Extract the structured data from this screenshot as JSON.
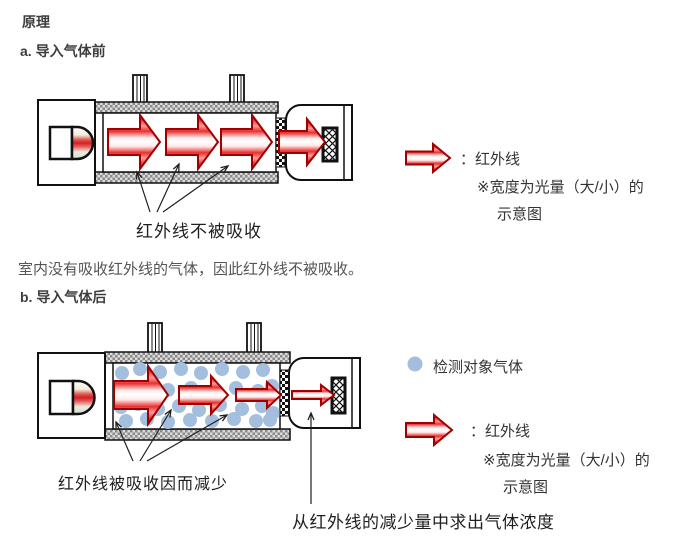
{
  "page": {
    "title": "原理",
    "background_color": "#ffffff"
  },
  "colors": {
    "infrared_red": "#d42020",
    "infrared_dark_red": "#a00000",
    "gas_blue": "#a3bfdd",
    "wall_gray": "#8a8a8a",
    "heading_text": "#3e3e3e",
    "body_text": "#555555",
    "label_text": "#1f1f1f"
  },
  "icons": {
    "infrared": "red-arrow-right-icon",
    "gas": "blue-circle-icon"
  },
  "section_a": {
    "heading": "a. 导入气体前",
    "diagram_label": "红外线不被吸收",
    "description": "室内没有吸收红外线的气体，因此红外线不被吸收。",
    "legend": {
      "infrared_label": "：红外线",
      "note_line1": "※宽度为光量（大/小）的",
      "note_line2": "示意图"
    }
  },
  "section_b": {
    "heading": "b. 导入气体后",
    "diagram_label": "红外线被吸收因而减少",
    "annotation": "从红外线的减少量中求出气体浓度",
    "legend": {
      "gas_label": "检测对象气体",
      "infrared_label": "：红外线",
      "note_line1": "※宽度为光量（大/小）的",
      "note_line2": "示意图"
    }
  }
}
